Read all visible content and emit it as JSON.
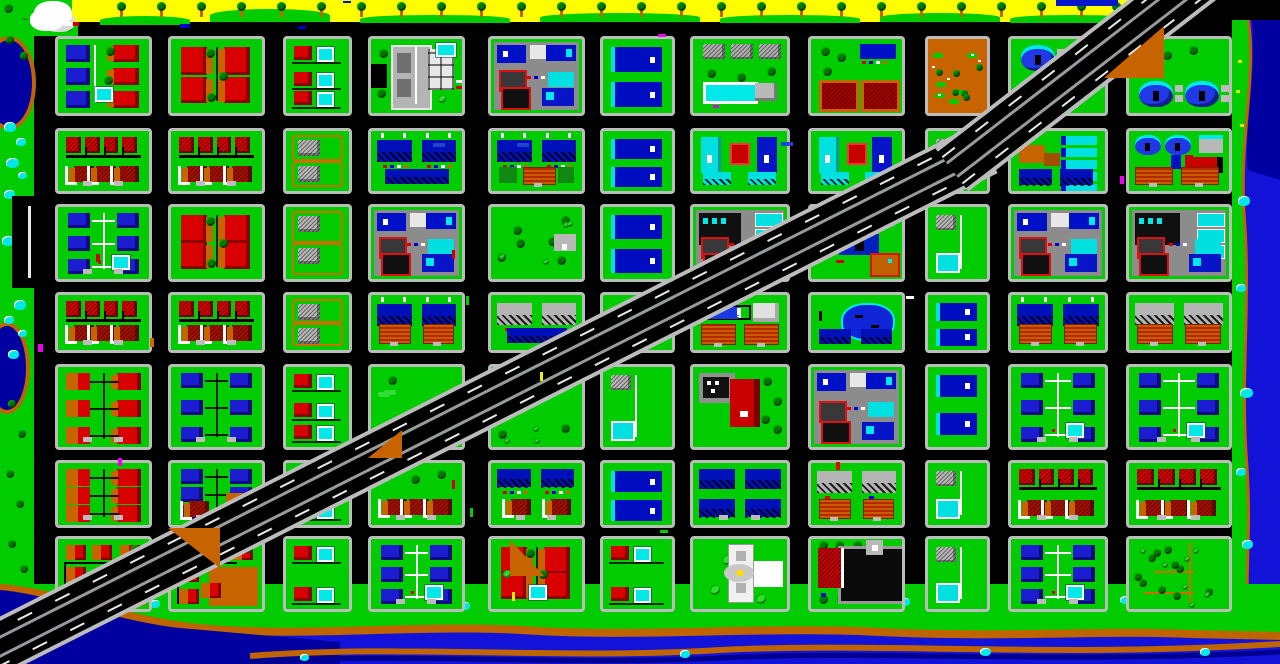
{
  "app": {
    "title": "pixel-city-overworld-map"
  },
  "palette": {
    "grass": "#00cc00",
    "road": "#000000",
    "sidewalk": "#bcbcbc",
    "beach": "#ffff00",
    "water": "#1212d8",
    "waterDark": "#0000a0",
    "bank": "#c06400",
    "pond": "#00e8e8",
    "houseRed": "#d80000",
    "houseRedDark": "#980000",
    "hipRed": "#a81000",
    "wallOrange": "#c86400",
    "houseBlue": "#1c1cd0",
    "slabBlue": "#0010b8",
    "cyan": "#00e0e0",
    "grayBldg": "#b4b4b4",
    "lotGray": "#8c8c8c",
    "domeBlue": "#2038e8",
    "white": "#ffffff",
    "treeDark": "#007800",
    "bushLight": "#2ee02e"
  },
  "grid": {
    "cols": [
      [
        55,
        97
      ],
      [
        168,
        97
      ],
      [
        283,
        69
      ],
      [
        368,
        97
      ],
      [
        488,
        97
      ],
      [
        600,
        75
      ],
      [
        690,
        100
      ],
      [
        808,
        97
      ],
      [
        925,
        65
      ],
      [
        1008,
        100
      ],
      [
        1126,
        106
      ]
    ],
    "rows": [
      [
        36,
        80
      ],
      [
        128,
        66
      ],
      [
        204,
        78
      ],
      [
        292,
        61
      ],
      [
        364,
        86
      ],
      [
        460,
        68
      ],
      [
        536,
        76
      ]
    ]
  },
  "blocks": [
    [
      0,
      0,
      "subMix",
      ""
    ],
    [
      1,
      0,
      "subRedL",
      "trees"
    ],
    [
      2,
      0,
      "nRed",
      ""
    ],
    [
      3,
      0,
      "civic",
      ""
    ],
    [
      4,
      0,
      "comm",
      ""
    ],
    [
      5,
      0,
      "nBlue",
      ""
    ],
    [
      6,
      0,
      "rec",
      ""
    ],
    [
      7,
      0,
      "barns",
      ""
    ],
    [
      8,
      0,
      "dirt",
      ""
    ],
    [
      9,
      0,
      "domes",
      "top"
    ],
    [
      10,
      0,
      "domes",
      "bottom"
    ],
    [
      0,
      1,
      "rowRed",
      ""
    ],
    [
      1,
      1,
      "rowRed",
      ""
    ],
    [
      2,
      1,
      "cot",
      ""
    ],
    [
      3,
      1,
      "aptsBlue",
      "slab"
    ],
    [
      4,
      1,
      "aptsBlue",
      "hedge"
    ],
    [
      5,
      1,
      "nBlue",
      "small"
    ],
    [
      6,
      1,
      "aptsCyan",
      ""
    ],
    [
      7,
      1,
      "aptsCyan",
      ""
    ],
    [
      8,
      1,
      "nGray",
      ""
    ],
    [
      9,
      1,
      "motel",
      ""
    ],
    [
      10,
      1,
      "domesCourts",
      ""
    ],
    [
      0,
      2,
      "subBlue",
      "lines"
    ],
    [
      1,
      2,
      "subRedL",
      "trees"
    ],
    [
      2,
      2,
      "cot",
      ""
    ],
    [
      3,
      2,
      "comm",
      ""
    ],
    [
      4,
      2,
      "park",
      "shop"
    ],
    [
      5,
      2,
      "nBlue",
      ""
    ],
    [
      6,
      2,
      "comm",
      "cyan"
    ],
    [
      7,
      2,
      "ind",
      ""
    ],
    [
      8,
      2,
      "nGray",
      ""
    ],
    [
      9,
      2,
      "comm",
      ""
    ],
    [
      10,
      2,
      "comm",
      "cyan"
    ],
    [
      0,
      3,
      "rowRed",
      ""
    ],
    [
      1,
      3,
      "rowRed",
      ""
    ],
    [
      2,
      3,
      "cot",
      ""
    ],
    [
      3,
      3,
      "aptsBlue",
      "courts"
    ],
    [
      4,
      3,
      "aptsGray",
      "slab"
    ],
    [
      5,
      3,
      "lawn",
      ""
    ],
    [
      6,
      3,
      "tanks",
      ""
    ],
    [
      7,
      3,
      "pond",
      ""
    ],
    [
      8,
      3,
      "nBlue",
      "small"
    ],
    [
      9,
      3,
      "aptsBlue",
      "courts"
    ],
    [
      10,
      3,
      "aptsGray",
      "courts"
    ],
    [
      0,
      4,
      "subOrg",
      ""
    ],
    [
      1,
      4,
      "subBlue",
      "fence"
    ],
    [
      2,
      4,
      "nRed",
      ""
    ],
    [
      3,
      4,
      "lawn",
      ""
    ],
    [
      4,
      4,
      "park",
      ""
    ],
    [
      5,
      4,
      "nGray",
      ""
    ],
    [
      6,
      4,
      "ind2",
      ""
    ],
    [
      7,
      4,
      "comm",
      ""
    ],
    [
      8,
      4,
      "nBlue",
      "small"
    ],
    [
      9,
      4,
      "subBlue",
      "lines"
    ],
    [
      10,
      4,
      "subBlue",
      "lines"
    ],
    [
      0,
      5,
      "subOrg",
      ""
    ],
    [
      1,
      5,
      "subBlue",
      "dirt"
    ],
    [
      2,
      5,
      "nRed",
      ""
    ],
    [
      3,
      5,
      "hipRow",
      ""
    ],
    [
      4,
      5,
      "aptsHip",
      ""
    ],
    [
      5,
      5,
      "nBlue",
      "small"
    ],
    [
      6,
      5,
      "aptsBlue2",
      ""
    ],
    [
      7,
      5,
      "aptsGray",
      "courts"
    ],
    [
      8,
      5,
      "nGray",
      ""
    ],
    [
      9,
      5,
      "rowRed",
      ""
    ],
    [
      10,
      5,
      "rowRed",
      ""
    ],
    [
      0,
      6,
      "clusterOrg",
      ""
    ],
    [
      1,
      6,
      "clusterOrg",
      ""
    ],
    [
      2,
      6,
      "nRed",
      ""
    ],
    [
      3,
      6,
      "subBlue",
      "lines"
    ],
    [
      4,
      6,
      "subRedL",
      "pools"
    ],
    [
      5,
      6,
      "nRed",
      ""
    ],
    [
      6,
      6,
      "mon",
      ""
    ],
    [
      7,
      6,
      "mall",
      ""
    ],
    [
      8,
      6,
      "nGray",
      ""
    ],
    [
      9,
      6,
      "subBlue",
      "lines"
    ],
    [
      10,
      6,
      "forest",
      ""
    ]
  ],
  "beach": {
    "x": 72,
    "w": 1066,
    "h": 22,
    "palms": [
      117,
      157,
      197,
      237,
      277,
      317,
      357,
      397,
      437,
      477,
      517,
      557,
      597,
      637,
      677,
      717,
      757,
      797,
      837,
      877,
      917,
      957,
      997,
      1037,
      1077,
      1112
    ],
    "fringe": [
      [
        100,
        16,
        90,
        9
      ],
      [
        210,
        9,
        120,
        13
      ],
      [
        360,
        15,
        150,
        8
      ],
      [
        540,
        13,
        160,
        9
      ],
      [
        720,
        15,
        140,
        8
      ],
      [
        880,
        13,
        120,
        9
      ],
      [
        1010,
        15,
        125,
        8
      ]
    ],
    "topBar": [
      1056,
      0,
      62,
      6
    ],
    "cloud": [
      34,
      1,
      38,
      26
    ]
  },
  "highway": {
    "segments": [
      {
        "x": -50,
        "y": 672,
        "len": 1160,
        "angle": -26.8
      },
      {
        "x": 952,
        "y": 170,
        "len": 380,
        "angle": -37.7
      }
    ],
    "dirtTriangles": [
      [
        1104,
        26,
        60,
        52,
        "ne"
      ],
      [
        168,
        528,
        52,
        40,
        "se"
      ],
      [
        510,
        540,
        34,
        36,
        "sw"
      ],
      [
        368,
        430,
        34,
        28,
        "ne"
      ]
    ]
  },
  "leftShore": {
    "lakes": [
      [
        -18,
        36,
        46,
        86
      ],
      [
        -16,
        322,
        38,
        84
      ]
    ],
    "ponds": [
      [
        4,
        122,
        12
      ],
      [
        16,
        138,
        10
      ],
      [
        6,
        158,
        13
      ],
      [
        18,
        172,
        9
      ],
      [
        4,
        190,
        11
      ],
      [
        2,
        236,
        12
      ],
      [
        14,
        250,
        9
      ],
      [
        14,
        300,
        12
      ],
      [
        4,
        316,
        10
      ],
      [
        18,
        330,
        9
      ],
      [
        8,
        350,
        11
      ]
    ],
    "trees": [
      [
        6,
        36
      ],
      [
        20,
        52
      ],
      [
        8,
        400
      ],
      [
        18,
        430
      ],
      [
        6,
        470
      ],
      [
        16,
        500
      ],
      [
        8,
        540
      ],
      [
        20,
        565
      ]
    ],
    "layby": [
      12,
      196,
      46,
      92
    ]
  },
  "rightShore": {
    "ponds": [
      [
        1238,
        196,
        12
      ],
      [
        1236,
        284,
        10
      ],
      [
        1240,
        388,
        13
      ],
      [
        1236,
        468,
        10
      ],
      [
        1242,
        540,
        11
      ]
    ]
  },
  "bottomShore": {
    "ponds": [
      [
        60,
        596,
        14
      ],
      [
        150,
        600,
        10
      ],
      [
        340,
        598,
        12
      ],
      [
        460,
        602,
        10
      ],
      [
        560,
        596,
        13
      ],
      [
        640,
        600,
        9
      ],
      [
        760,
        594,
        12
      ],
      [
        900,
        598,
        10
      ],
      [
        1020,
        600,
        12
      ],
      [
        1120,
        596,
        11
      ],
      [
        680,
        650,
        10
      ],
      [
        300,
        654,
        9
      ],
      [
        980,
        648,
        11
      ],
      [
        1200,
        648,
        10
      ]
    ]
  },
  "cars": [
    [
      64,
      22,
      "#ffffff",
      8,
      4
    ],
    [
      73,
      22,
      "#cc0000",
      6,
      4
    ],
    [
      180,
      24,
      "#0000cc",
      10,
      4
    ],
    [
      298,
      26,
      "#0000cc",
      8,
      3
    ],
    [
      456,
      80,
      "#ffffff",
      6,
      3
    ],
    [
      456,
      86,
      "#cc0000",
      6,
      3
    ],
    [
      433,
      143,
      "#2244cc",
      12,
      4
    ],
    [
      517,
      143,
      "#2244cc",
      12,
      4
    ],
    [
      781,
      142,
      "#2244cc",
      12,
      4
    ],
    [
      96,
      254,
      "#cc0000",
      4,
      8
    ],
    [
      150,
      338,
      "#cc6600",
      4,
      9
    ],
    [
      38,
      344,
      "#ee00ee",
      5,
      8
    ],
    [
      118,
      458,
      "#ee00ee",
      4,
      8
    ],
    [
      452,
      250,
      "#cc0000",
      3,
      9
    ],
    [
      466,
      296,
      "#00cc00",
      3,
      9
    ],
    [
      452,
      480,
      "#cc0000",
      3,
      9
    ],
    [
      470,
      508,
      "#00cc00",
      3,
      9
    ],
    [
      540,
      372,
      "#eeee00",
      3,
      9
    ],
    [
      512,
      592,
      "#eeee00",
      3,
      9
    ],
    [
      836,
      462,
      "#ee0000",
      4,
      8
    ],
    [
      1120,
      176,
      "#ee00ee",
      4,
      8
    ],
    [
      836,
      260,
      "#cc0000",
      8,
      3
    ],
    [
      906,
      296,
      "#ffffff",
      8,
      3
    ],
    [
      660,
      530,
      "#00cc00",
      8,
      3
    ],
    [
      658,
      34,
      "#ee00ee",
      8,
      3
    ],
    [
      343,
      1,
      "#0018c8",
      8,
      2
    ]
  ]
}
